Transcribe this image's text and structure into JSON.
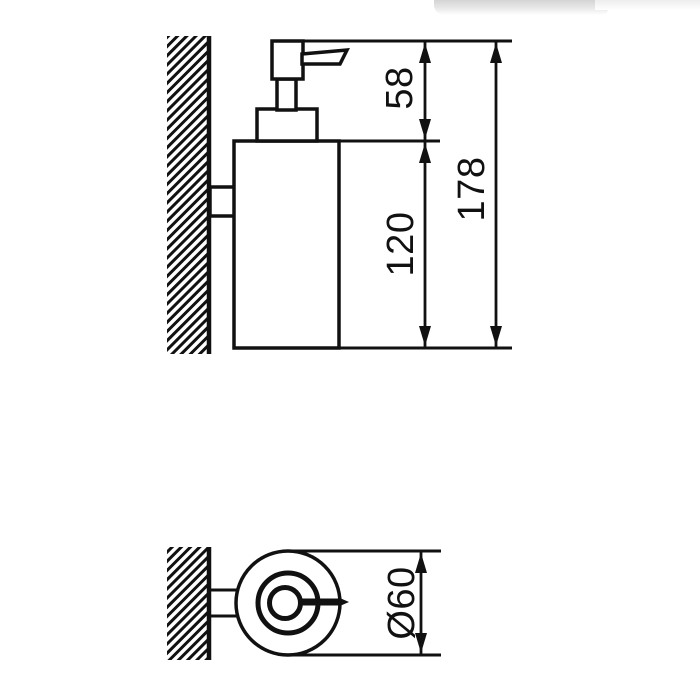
{
  "drawing": {
    "subject": "wall-mounted-soap-dispenser-dimension-drawing",
    "side_view": {
      "dimensions": {
        "pump_height": "58",
        "body_height": "120",
        "total_height": "178"
      }
    },
    "top_view": {
      "dimensions": {
        "diameter": "Ø60"
      }
    },
    "colors": {
      "line": "#111111",
      "background": "#ffffff"
    }
  }
}
